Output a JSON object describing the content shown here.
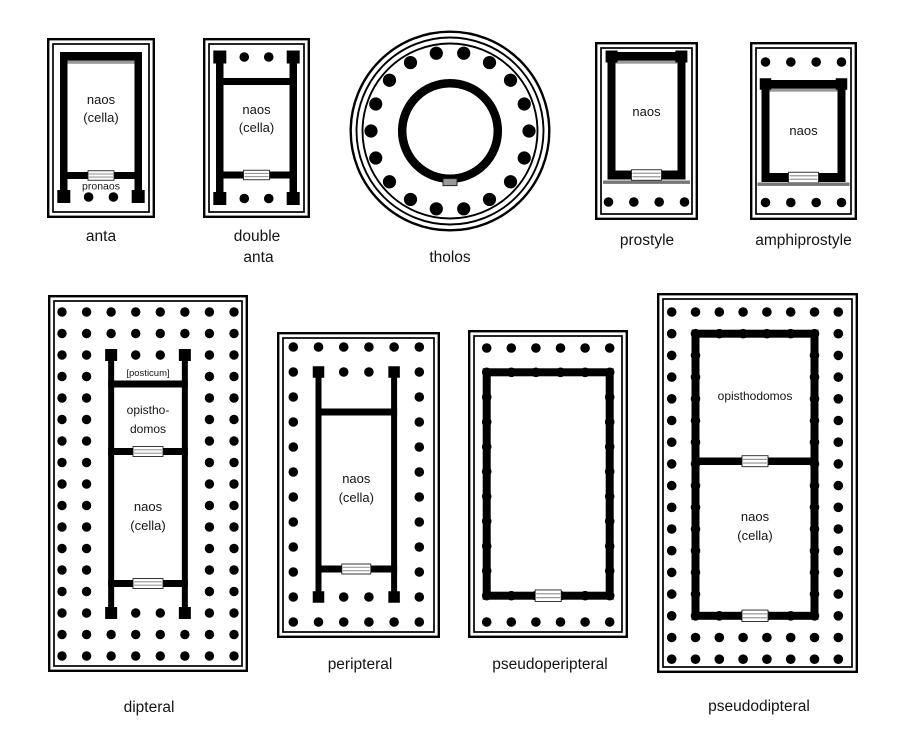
{
  "diagram": {
    "subject": "Greek temple plan types",
    "colors": {
      "ink": "#000000",
      "background": "#ffffff",
      "wall_shade": "#999999",
      "stylobate_shade": "#777777",
      "door_stripe": "#999999",
      "tholos_door": "#999999"
    }
  },
  "plans": {
    "anta": {
      "caption": "anta",
      "labels": {
        "naos": "naos",
        "cella": "(cella)",
        "pronaos": "pronaos"
      },
      "porch_columns": 2
    },
    "double_anta": {
      "caption_line1": "double",
      "caption_line2": "anta",
      "labels": {
        "naos": "naos",
        "cella": "(cella)"
      },
      "front_columns": 2,
      "rear_columns": 2
    },
    "tholos": {
      "caption": "tholos",
      "outer_columns": 18
    },
    "prostyle": {
      "caption": "prostyle",
      "labels": {
        "naos": "naos"
      },
      "front_columns": 4
    },
    "amphiprostyle": {
      "caption": "amphiprostyle",
      "labels": {
        "naos": "naos"
      },
      "front_columns": 4,
      "rear_columns": 4
    },
    "dipteral": {
      "caption": "dipteral",
      "labels": {
        "posticum": "[posticum]",
        "opisthodomos_line1": "opistho-",
        "opisthodomos_line2": "domos",
        "naos": "naos",
        "cella": "(cella)"
      },
      "front_columns": 8,
      "colonnade_rows": 17
    },
    "peripteral": {
      "caption": "peripteral",
      "labels": {
        "naos": "naos",
        "cella": "(cella)"
      },
      "front_columns": 6,
      "colonnade_rows": 12
    },
    "pseudoperipteral": {
      "caption": "pseudoperipteral",
      "front_columns": 6
    },
    "pseudodipteral": {
      "caption": "pseudodipteral",
      "labels": {
        "opisthodomos": "opisthodomos",
        "naos": "naos",
        "cella": "(cella)"
      },
      "front_columns": 8,
      "colonnade_rows": 17
    }
  }
}
